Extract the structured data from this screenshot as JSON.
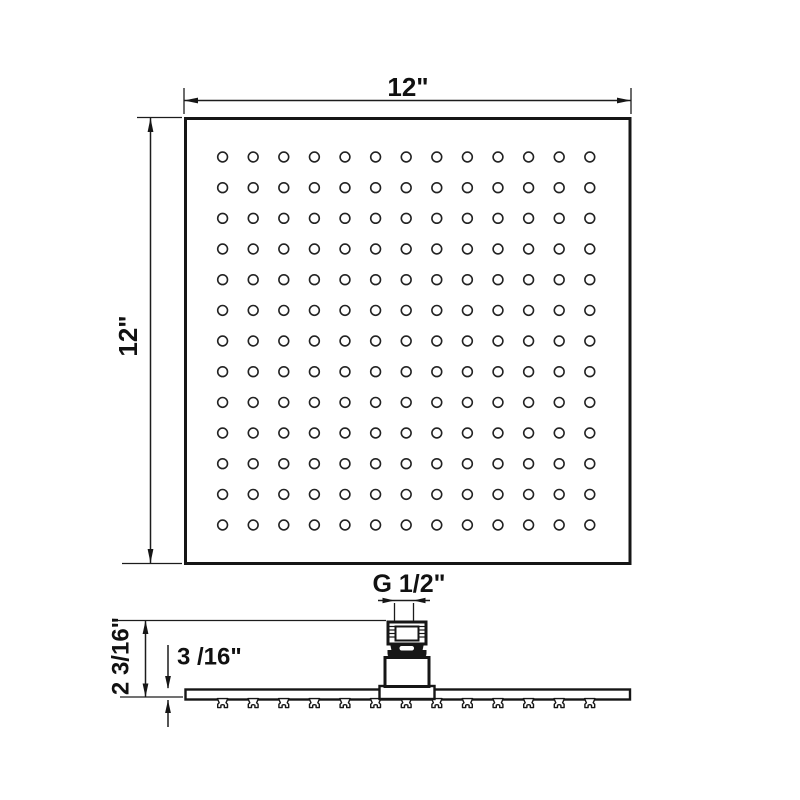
{
  "drawing": {
    "title": "shower-head-dimension-drawing",
    "line_color": "#161616",
    "background_color": "#ffffff",
    "top_view": {
      "width_label": "12\"",
      "height_label": "12\"",
      "hole_rows": 13,
      "hole_cols": 13
    },
    "side_view": {
      "thread_label": "G 1/2\"",
      "overall_height_label": "2 3/16\"",
      "plate_thickness_label": "3 /16\"",
      "nozzle_count": 13
    }
  }
}
